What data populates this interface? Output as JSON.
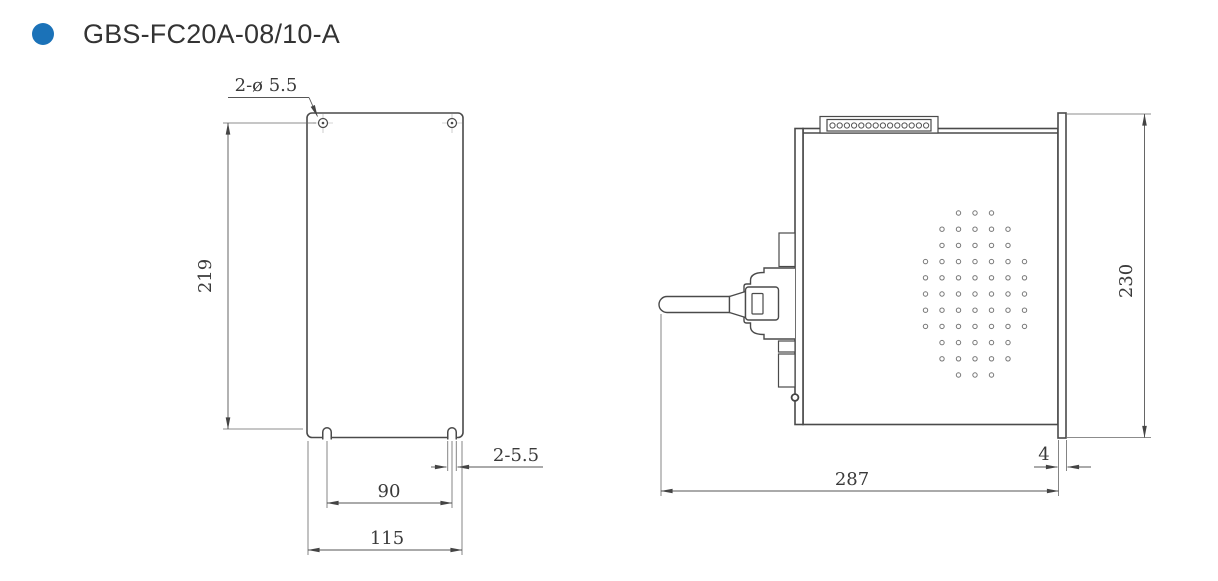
{
  "header": {
    "title": "GBS-FC20A-08/10-A",
    "bullet_color": "#1b72b8"
  },
  "front_view": {
    "name": "front mounting view",
    "labels": {
      "top_holes": "2-ø 5.5",
      "height": "219",
      "bottom_slots": "2-5.5",
      "slot_spacing": "90",
      "width": "115"
    }
  },
  "side_view": {
    "name": "side view",
    "labels": {
      "depth": "287",
      "height": "230",
      "panel_thickness": "4"
    },
    "vent_hole_rows": [
      3,
      5,
      5,
      7,
      7,
      7,
      7,
      7,
      5,
      5,
      3
    ],
    "terminal_hole_count": 14
  }
}
